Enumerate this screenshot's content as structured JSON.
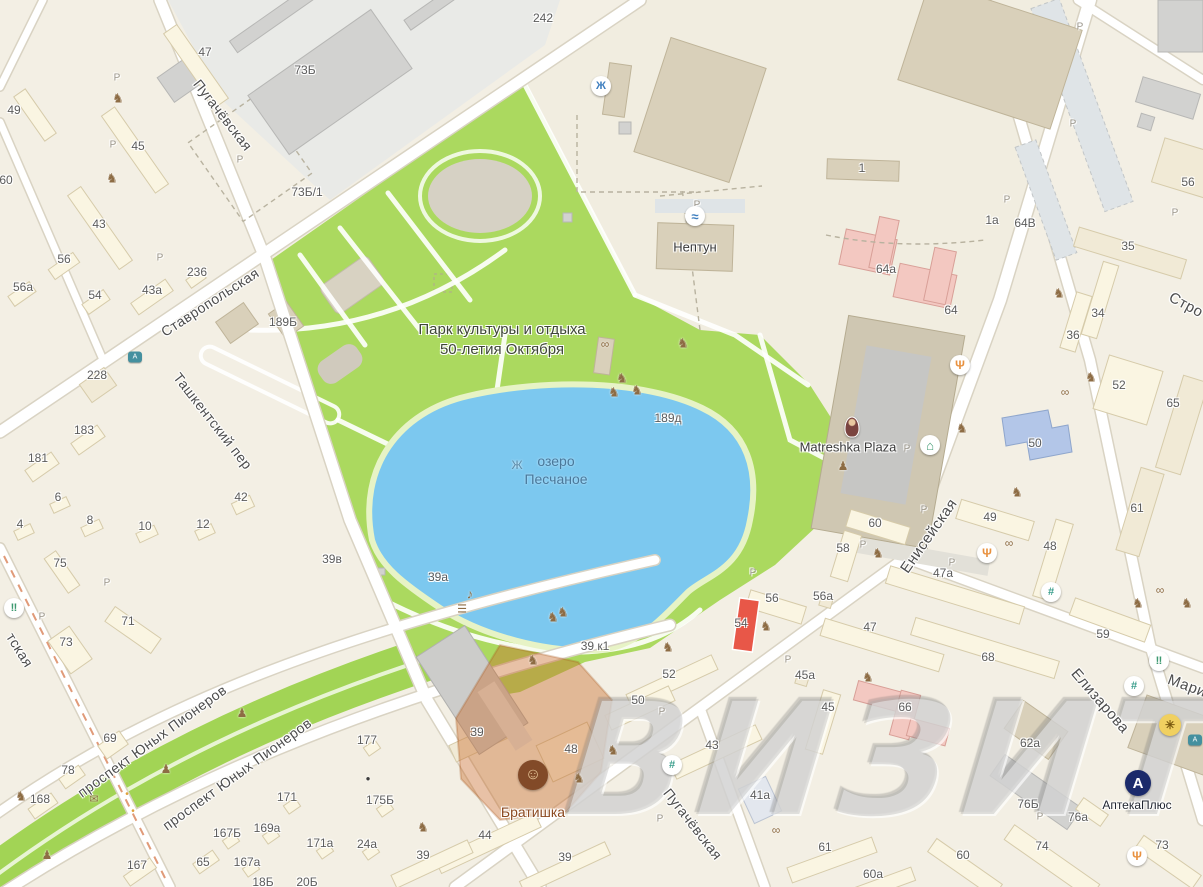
{
  "map": {
    "watermark": "ВИЗИТ",
    "park": {
      "line1": "Парк культуры и отдыха",
      "line2": "50-летия Октября"
    },
    "lake": {
      "line1": "озеро",
      "line2": "Песчаное"
    },
    "colors": {
      "park": "#abd95f",
      "lake": "#7cc8ef",
      "highlight-orange": "rgba(199,108,42,.42)",
      "red-building": "#e85748",
      "pink-building": "#f3c8c1",
      "blue-building": "#b3c6e8",
      "watermark-gray": "#aaaaaa",
      "poi-brown": "#8c4a21",
      "apteka-navy": "#1b2a6b"
    },
    "street_labels": [
      {
        "text": "Пугачёвская",
        "x": 223,
        "y": 115,
        "angle": 52,
        "size": 14
      },
      {
        "text": "Ставропольская",
        "x": 210,
        "y": 302,
        "angle": -33,
        "size": 14
      },
      {
        "text": "Ташкентский пер",
        "x": 213,
        "y": 421,
        "angle": 52,
        "size": 14
      },
      {
        "text": "тская",
        "x": 20,
        "y": 650,
        "angle": 58,
        "size": 14
      },
      {
        "text": "проспект Юных Пионеров",
        "x": 152,
        "y": 741,
        "angle": -36,
        "size": 14
      },
      {
        "text": "проспект Юных Пионеров",
        "x": 237,
        "y": 774,
        "angle": -36,
        "size": 14
      },
      {
        "text": "Енисейская",
        "x": 929,
        "y": 536,
        "angle": -55,
        "size": 15
      },
      {
        "text": "Пугачёвская",
        "x": 693,
        "y": 824,
        "angle": 52,
        "size": 14
      },
      {
        "text": "Елизарова",
        "x": 1100,
        "y": 701,
        "angle": 49,
        "size": 15
      },
      {
        "text": "Мари",
        "x": 1187,
        "y": 686,
        "angle": 20,
        "size": 15
      },
      {
        "text": "Стро",
        "x": 1186,
        "y": 305,
        "angle": 28,
        "size": 15
      }
    ],
    "building_labels": [
      {
        "t": "47",
        "x": 205,
        "y": 52
      },
      {
        "t": "49",
        "x": 14,
        "y": 110
      },
      {
        "t": "45",
        "x": 138,
        "y": 146
      },
      {
        "t": "60",
        "x": 6,
        "y": 180
      },
      {
        "t": "43",
        "x": 99,
        "y": 224
      },
      {
        "t": "56",
        "x": 64,
        "y": 259
      },
      {
        "t": "236",
        "x": 197,
        "y": 272
      },
      {
        "t": "56а",
        "x": 23,
        "y": 287
      },
      {
        "t": "43а",
        "x": 152,
        "y": 290
      },
      {
        "t": "54",
        "x": 95,
        "y": 295
      },
      {
        "t": "73Б",
        "x": 305,
        "y": 70
      },
      {
        "t": "73Б/1",
        "x": 307,
        "y": 192
      },
      {
        "t": "242",
        "x": 543,
        "y": 18
      },
      {
        "t": "228",
        "x": 97,
        "y": 375
      },
      {
        "t": "183",
        "x": 84,
        "y": 430
      },
      {
        "t": "181",
        "x": 38,
        "y": 458
      },
      {
        "t": "189Б",
        "x": 283,
        "y": 322
      },
      {
        "t": "6",
        "x": 58,
        "y": 497
      },
      {
        "t": "4",
        "x": 20,
        "y": 524
      },
      {
        "t": "8",
        "x": 90,
        "y": 520
      },
      {
        "t": "10",
        "x": 145,
        "y": 526
      },
      {
        "t": "12",
        "x": 203,
        "y": 524
      },
      {
        "t": "42",
        "x": 241,
        "y": 497
      },
      {
        "t": "39в",
        "x": 332,
        "y": 559
      },
      {
        "t": "75",
        "x": 60,
        "y": 563
      },
      {
        "t": "73",
        "x": 66,
        "y": 642
      },
      {
        "t": "71",
        "x": 128,
        "y": 621
      },
      {
        "t": "39а",
        "x": 438,
        "y": 577
      },
      {
        "t": "69",
        "x": 110,
        "y": 738
      },
      {
        "t": "78",
        "x": 68,
        "y": 770
      },
      {
        "t": "168",
        "x": 40,
        "y": 799
      },
      {
        "t": "167",
        "x": 137,
        "y": 865
      },
      {
        "t": "65",
        "x": 203,
        "y": 862
      },
      {
        "t": "18Б",
        "x": 263,
        "y": 882
      },
      {
        "t": "20Б",
        "x": 307,
        "y": 882
      },
      {
        "t": "167Б",
        "x": 227,
        "y": 833
      },
      {
        "t": "167а",
        "x": 247,
        "y": 862
      },
      {
        "t": "169а",
        "x": 267,
        "y": 828
      },
      {
        "t": "171",
        "x": 287,
        "y": 797
      },
      {
        "t": "171а",
        "x": 320,
        "y": 843
      },
      {
        "t": "24а",
        "x": 367,
        "y": 844
      },
      {
        "t": "175Б",
        "x": 380,
        "y": 800
      },
      {
        "t": "177",
        "x": 367,
        "y": 740
      },
      {
        "t": "1",
        "x": 862,
        "y": 168
      },
      {
        "t": "1а",
        "x": 992,
        "y": 220
      },
      {
        "t": "64В",
        "x": 1025,
        "y": 223
      },
      {
        "t": "35",
        "x": 1128,
        "y": 246
      },
      {
        "t": "56",
        "x": 1188,
        "y": 182
      },
      {
        "t": "64а",
        "x": 886,
        "y": 269
      },
      {
        "t": "64",
        "x": 951,
        "y": 310
      },
      {
        "t": "34",
        "x": 1098,
        "y": 313
      },
      {
        "t": "36",
        "x": 1073,
        "y": 335
      },
      {
        "t": "52",
        "x": 1119,
        "y": 385
      },
      {
        "t": "65",
        "x": 1173,
        "y": 403
      },
      {
        "t": "50",
        "x": 1035,
        "y": 443
      },
      {
        "t": "189д",
        "x": 668,
        "y": 418
      },
      {
        "t": "49",
        "x": 990,
        "y": 517
      },
      {
        "t": "48",
        "x": 1050,
        "y": 546
      },
      {
        "t": "61",
        "x": 1137,
        "y": 508
      },
      {
        "t": "60",
        "x": 875,
        "y": 523
      },
      {
        "t": "58",
        "x": 843,
        "y": 548
      },
      {
        "t": "56",
        "x": 772,
        "y": 598
      },
      {
        "t": "56а",
        "x": 823,
        "y": 596
      },
      {
        "t": "54",
        "x": 741,
        "y": 623
      },
      {
        "t": "47",
        "x": 870,
        "y": 627
      },
      {
        "t": "47а",
        "x": 943,
        "y": 573
      },
      {
        "t": "59",
        "x": 1103,
        "y": 634
      },
      {
        "t": "68",
        "x": 988,
        "y": 657
      },
      {
        "t": "45а",
        "x": 805,
        "y": 675
      },
      {
        "t": "45",
        "x": 828,
        "y": 707
      },
      {
        "t": "66",
        "x": 905,
        "y": 707
      },
      {
        "t": "39 к1",
        "x": 595,
        "y": 646
      },
      {
        "t": "62а",
        "x": 1030,
        "y": 743
      },
      {
        "t": "76Б",
        "x": 1028,
        "y": 804
      },
      {
        "t": "76а",
        "x": 1078,
        "y": 817
      },
      {
        "t": "74",
        "x": 1042,
        "y": 846
      },
      {
        "t": "73",
        "x": 1162,
        "y": 845
      },
      {
        "t": "60",
        "x": 963,
        "y": 855
      },
      {
        "t": "60а",
        "x": 873,
        "y": 874
      },
      {
        "t": "61",
        "x": 825,
        "y": 847
      },
      {
        "t": "52",
        "x": 669,
        "y": 674
      },
      {
        "t": "50",
        "x": 638,
        "y": 700
      },
      {
        "t": "48",
        "x": 571,
        "y": 749
      },
      {
        "t": "43",
        "x": 712,
        "y": 745
      },
      {
        "t": "41а",
        "x": 760,
        "y": 795
      },
      {
        "t": "44",
        "x": 485,
        "y": 835
      },
      {
        "t": "39",
        "x": 423,
        "y": 855
      },
      {
        "t": "39",
        "x": 565,
        "y": 857
      },
      {
        "t": "39",
        "x": 477,
        "y": 732
      }
    ],
    "poi_labels": [
      {
        "name": "neptun",
        "text": "Нептун",
        "x": 695,
        "y": 247,
        "color": "#3a3a3a",
        "size": 13
      },
      {
        "name": "matreshka-plaza",
        "text": "Matreshka Plaza",
        "x": 848,
        "y": 447,
        "color": "#3a3a3a",
        "size": 13
      },
      {
        "name": "bratishka",
        "text": "Братишка",
        "x": 533,
        "y": 812,
        "color": "#8c4a21",
        "size": 14
      },
      {
        "name": "apteka-plus",
        "text": "АптекаПлюс",
        "x": 1137,
        "y": 805,
        "color": "#1f2430",
        "size": 12
      }
    ],
    "parking": {
      "letter": "P",
      "positions": [
        [
          117,
          78
        ],
        [
          113,
          145
        ],
        [
          160,
          258
        ],
        [
          240,
          160
        ],
        [
          697,
          205
        ],
        [
          1080,
          27
        ],
        [
          1073,
          124
        ],
        [
          1007,
          200
        ],
        [
          1175,
          213
        ],
        [
          863,
          545
        ],
        [
          924,
          510
        ],
        [
          788,
          660
        ],
        [
          662,
          712
        ],
        [
          660,
          819
        ],
        [
          1040,
          817
        ],
        [
          753,
          573
        ],
        [
          952,
          563
        ],
        [
          907,
          449
        ],
        [
          107,
          583
        ],
        [
          42,
          617
        ]
      ]
    },
    "icon_defs": {
      "playground": {
        "glyph": "♞",
        "color": "#8d6c44",
        "size": 13,
        "poi": false
      },
      "dumbbell": {
        "glyph": "∞",
        "color": "#8d6c44",
        "size": 12,
        "poi": false
      },
      "statue": {
        "glyph": "♟",
        "color": "#8d6c44",
        "size": 12,
        "poi": false
      },
      "mailbox": {
        "glyph": "✉",
        "color": "#8d6c44",
        "size": 11,
        "poi": false
      },
      "stage-mic": {
        "glyph": "♪",
        "color": "#8d6c44",
        "size": 13,
        "poi": false
      },
      "library-book": {
        "glyph": "☰",
        "color": "#8d6c44",
        "size": 11,
        "poi": false
      },
      "fuel-drop": {
        "glyph": "●",
        "color": "#3c3c3c",
        "size": 8,
        "poi": false
      },
      "traffic-light": {
        "glyph": "•",
        "color": "#e0a23c",
        "size": 10,
        "poi": false
      },
      "fountain": {
        "glyph": "Ж",
        "color": "#5a8aa8",
        "size": 12,
        "poi": false
      },
      "fountain-circle": {
        "shape": "circle",
        "d": 20,
        "glyph": "Ж",
        "color": "#3f7fbf",
        "size": 11,
        "poi": true
      },
      "pool": {
        "shape": "circle",
        "d": 20,
        "glyph": "≈",
        "color": "#3f7fbf",
        "size": 13,
        "poi": true
      },
      "restaurant": {
        "shape": "circle",
        "d": 20,
        "glyph": "Ψ",
        "color": "#e8913f",
        "size": 12,
        "poi": true
      },
      "hotel": {
        "shape": "circle",
        "d": 20,
        "glyph": "⌂",
        "color": "#3d9970",
        "size": 13,
        "poi": true
      },
      "beer-shop": {
        "shape": "circle",
        "d": 20,
        "glyph": "‼",
        "color": "#3d9970",
        "size": 11,
        "poi": true
      },
      "supermarket": {
        "shape": "circle",
        "d": 20,
        "glyph": "#",
        "color": "#3a9e8c",
        "size": 11,
        "poi": true
      },
      "landmark": {
        "shape": "circle",
        "d": 22,
        "bg": "#f0d060",
        "glyph": "✳",
        "color": "#7a5a10",
        "size": 12,
        "poi": true
      },
      "apteka-logo": {
        "shape": "circle",
        "d": 26,
        "bg": "#1b2a6b",
        "glyph": "A",
        "color": "#ffffff",
        "size": 15,
        "poi": true
      },
      "bratishka-logo": {
        "shape": "circle",
        "d": 30,
        "bg": "#824a28",
        "glyph": "☺",
        "color": "#e8c89a",
        "size": 16,
        "poi": true
      },
      "matryoshka": {
        "shape": "matry",
        "poi": true
      },
      "bus-stop": {
        "shape": "sq",
        "w": 14,
        "h": 11,
        "glyph": "А",
        "size": 7,
        "poi": true
      }
    },
    "icons": [
      {
        "type": "playground",
        "x": 118,
        "y": 98
      },
      {
        "type": "playground",
        "x": 112,
        "y": 178
      },
      {
        "type": "playground",
        "x": 1059,
        "y": 293
      },
      {
        "type": "playground",
        "x": 962,
        "y": 428
      },
      {
        "type": "playground",
        "x": 1017,
        "y": 492
      },
      {
        "type": "playground",
        "x": 878,
        "y": 553
      },
      {
        "type": "playground",
        "x": 766,
        "y": 626
      },
      {
        "type": "playground",
        "x": 868,
        "y": 677
      },
      {
        "type": "playground",
        "x": 1138,
        "y": 603
      },
      {
        "type": "playground",
        "x": 1187,
        "y": 603
      },
      {
        "type": "playground",
        "x": 613,
        "y": 750
      },
      {
        "type": "playground",
        "x": 579,
        "y": 778
      },
      {
        "type": "playground",
        "x": 423,
        "y": 827
      },
      {
        "type": "playground",
        "x": 668,
        "y": 647
      },
      {
        "type": "playground",
        "x": 21,
        "y": 796
      },
      {
        "type": "playground",
        "x": 553,
        "y": 617
      },
      {
        "type": "playground",
        "x": 533,
        "y": 660
      },
      {
        "type": "playground",
        "x": 563,
        "y": 612
      },
      {
        "type": "playground",
        "x": 1091,
        "y": 377
      },
      {
        "type": "playground",
        "x": 622,
        "y": 378
      },
      {
        "type": "playground",
        "x": 637,
        "y": 390
      },
      {
        "type": "playground",
        "x": 614,
        "y": 392
      },
      {
        "type": "playground",
        "x": 683,
        "y": 343
      },
      {
        "type": "dumbbell",
        "x": 605,
        "y": 344
      },
      {
        "type": "dumbbell",
        "x": 1065,
        "y": 392
      },
      {
        "type": "dumbbell",
        "x": 1009,
        "y": 543
      },
      {
        "type": "dumbbell",
        "x": 1160,
        "y": 590
      },
      {
        "type": "dumbbell",
        "x": 776,
        "y": 830
      },
      {
        "type": "statue",
        "x": 242,
        "y": 713
      },
      {
        "type": "statue",
        "x": 166,
        "y": 769
      },
      {
        "type": "statue",
        "x": 47,
        "y": 855
      },
      {
        "type": "statue",
        "x": 843,
        "y": 466
      },
      {
        "type": "mailbox",
        "x": 94,
        "y": 800
      },
      {
        "type": "stage-mic",
        "x": 470,
        "y": 594
      },
      {
        "type": "library-book",
        "x": 462,
        "y": 610
      },
      {
        "type": "fuel-drop",
        "x": 368,
        "y": 779
      },
      {
        "type": "traffic-light",
        "x": 127,
        "y": 795
      },
      {
        "type": "traffic-light",
        "x": 133,
        "y": 812
      },
      {
        "type": "fountain",
        "x": 517,
        "y": 465
      },
      {
        "type": "fountain-circle",
        "x": 601,
        "y": 86
      },
      {
        "type": "pool",
        "x": 695,
        "y": 216
      },
      {
        "type": "restaurant",
        "x": 960,
        "y": 365
      },
      {
        "type": "restaurant",
        "x": 987,
        "y": 553
      },
      {
        "type": "restaurant",
        "x": 1137,
        "y": 856
      },
      {
        "type": "hotel",
        "x": 930,
        "y": 445
      },
      {
        "type": "beer-shop",
        "x": 14,
        "y": 608
      },
      {
        "type": "beer-shop",
        "x": 1159,
        "y": 661
      },
      {
        "type": "supermarket",
        "x": 1051,
        "y": 592
      },
      {
        "type": "supermarket",
        "x": 1134,
        "y": 686
      },
      {
        "type": "supermarket",
        "x": 672,
        "y": 765
      },
      {
        "type": "landmark",
        "x": 1170,
        "y": 725
      },
      {
        "type": "apteka-logo",
        "x": 1138,
        "y": 783
      },
      {
        "type": "bratishka-logo",
        "x": 533,
        "y": 775
      },
      {
        "type": "matryoshka",
        "x": 852,
        "y": 427
      },
      {
        "type": "bus-stop",
        "x": 135,
        "y": 357
      },
      {
        "type": "bus-stop",
        "x": 1195,
        "y": 740
      }
    ]
  }
}
